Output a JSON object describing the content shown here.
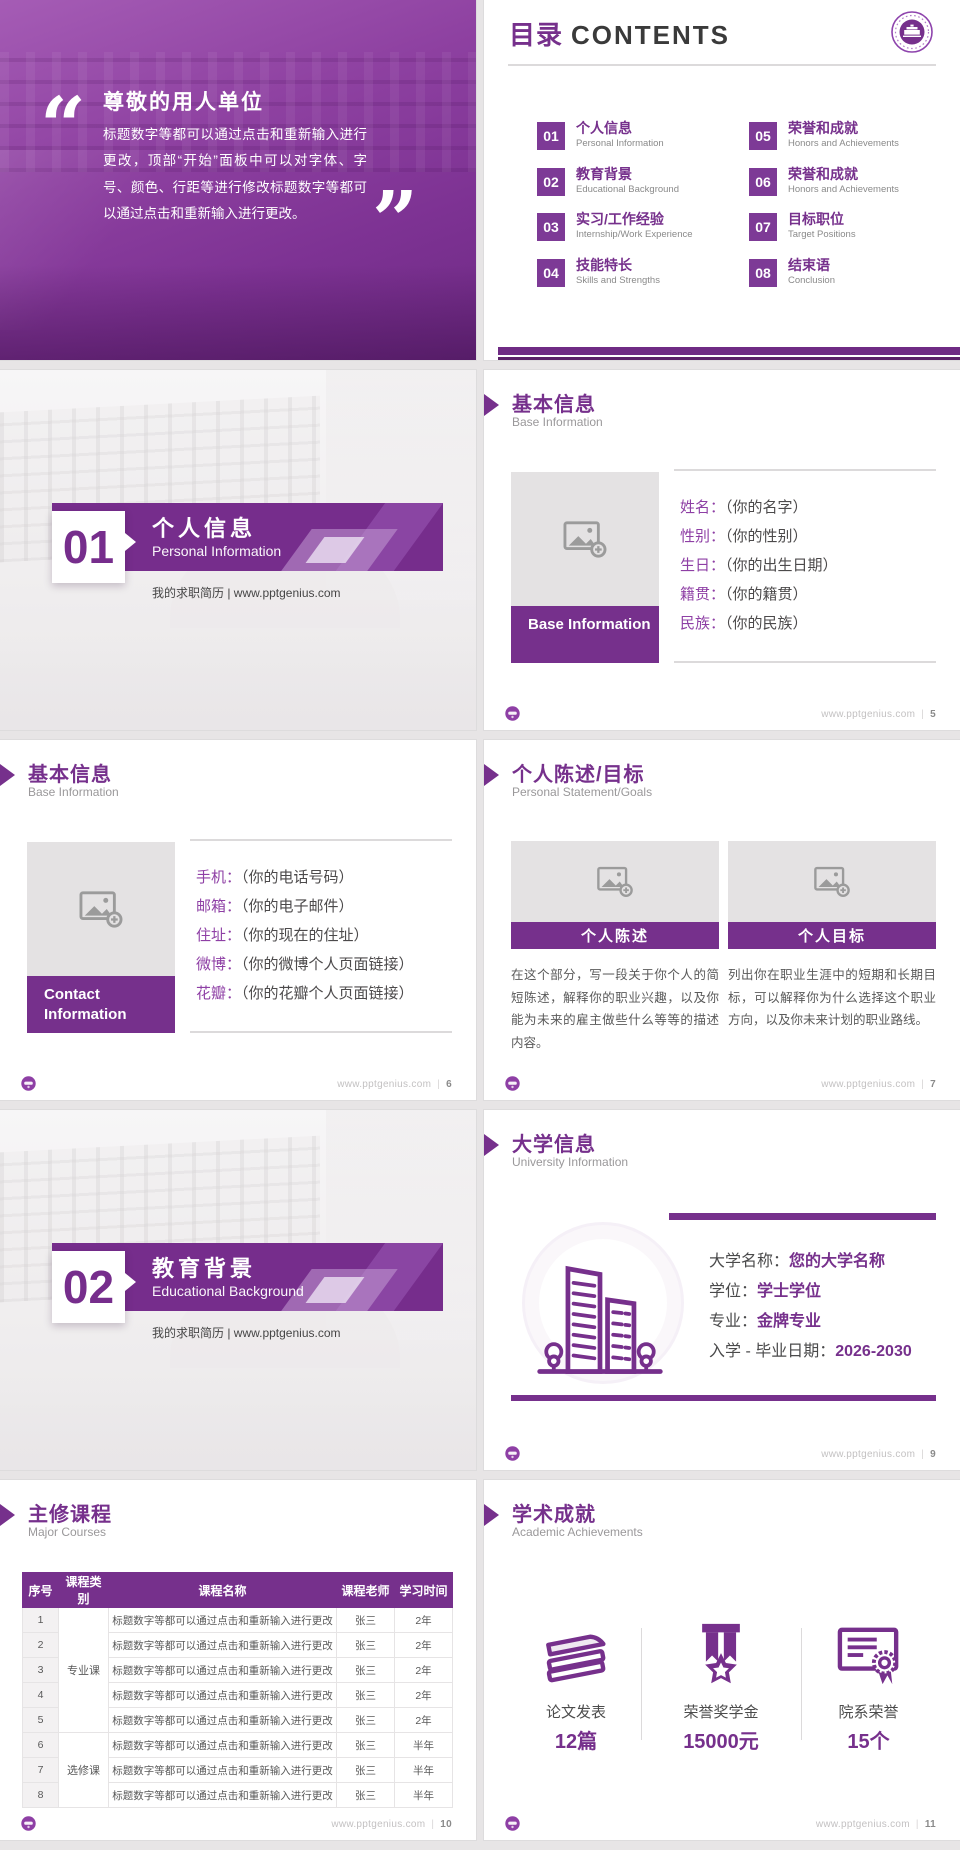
{
  "colors": {
    "accent": "#76308C",
    "accent_badge": "#7D3A96",
    "accent_deep": "#5B2169",
    "banner_bar": "#6F2B84",
    "field_label": "#8E3FA5",
    "text_dark": "#3A3A3A",
    "text_body": "#595959",
    "text_muted": "#9A989A",
    "footer_text": "#C3C1C2",
    "placeholder_bg": "#E4E2E3"
  },
  "footer_site": "www.pptgenius.com",
  "footer_sep": "|",
  "cover": {
    "open_quote": "“",
    "close_quote": "”",
    "title": "尊敬的用人单位",
    "body": "标题数字等都可以通过点击和重新输入进行更改，顶部“开始”面板中可以对字体、字号、颜色、行距等进行修改标题数字等都可以通过点击和重新输入进行更改。"
  },
  "contents": {
    "title_zh": "目录",
    "title_en": "CONTENTS",
    "items": [
      {
        "num": "01",
        "zh": "个人信息",
        "en": "Personal Information"
      },
      {
        "num": "02",
        "zh": "教育背景",
        "en": "Educational Background"
      },
      {
        "num": "03",
        "zh": "实习/工作经验",
        "en": "Internship/Work Experience"
      },
      {
        "num": "04",
        "zh": "技能特长",
        "en": "Skills and Strengths"
      },
      {
        "num": "05",
        "zh": "荣誉和成就",
        "en": "Honors and Achievements"
      },
      {
        "num": "06",
        "zh": "荣誉和成就",
        "en": "Honors and Achievements"
      },
      {
        "num": "07",
        "zh": "目标职位",
        "en": "Target Positions"
      },
      {
        "num": "08",
        "zh": "结束语",
        "en": "Conclusion"
      }
    ]
  },
  "section1": {
    "num": "01",
    "zh": "个人信息",
    "en": "Personal Information",
    "tagline": "我的求职简历 | www.pptgenius.com"
  },
  "section2": {
    "num": "02",
    "zh": "教育背景",
    "en": "Educational Background",
    "tagline": "我的求职简历 | www.pptgenius.com"
  },
  "base_info": {
    "zh": "基本信息",
    "en": "Base Information",
    "label": "Base Information",
    "fields": [
      {
        "k": "姓名：",
        "v": "（你的名字）"
      },
      {
        "k": "性别：",
        "v": "（你的性别）"
      },
      {
        "k": "生日：",
        "v": "（你的出生日期）"
      },
      {
        "k": "籍贯：",
        "v": "（你的籍贯）"
      },
      {
        "k": "民族：",
        "v": "（你的民族）"
      }
    ],
    "page": "5"
  },
  "contact": {
    "zh": "基本信息",
    "en": "Base Information",
    "label": "Contact Information",
    "fields": [
      {
        "k": "手机：",
        "v": "（你的电话号码）"
      },
      {
        "k": "邮箱：",
        "v": "（你的电子邮件）"
      },
      {
        "k": "住址：",
        "v": "（你的现在的住址）"
      },
      {
        "k": "微博：",
        "v": "（你的微博个人页面链接）"
      },
      {
        "k": "花瓣：",
        "v": "（你的花瓣个人页面链接）"
      }
    ],
    "page": "6"
  },
  "statement": {
    "zh": "个人陈述/目标",
    "en": "Personal Statement/Goals",
    "cards": [
      {
        "title": "个人陈述",
        "body": "在这个部分，写一段关于你个人的简短陈述，解释你的职业兴趣，以及你能为未来的雇主做些什么等等的描述内容。"
      },
      {
        "title": "个人目标",
        "body": "列出你在职业生涯中的短期和长期目标，可以解释你为什么选择这个职业方向，以及你未来计划的职业路线。"
      }
    ],
    "page": "7"
  },
  "university": {
    "zh": "大学信息",
    "en": "University Information",
    "fields": [
      {
        "k": "大学名称：",
        "v": "您的大学名称"
      },
      {
        "k": "学位：",
        "v": "学士学位"
      },
      {
        "k": "专业：",
        "v": "金牌专业"
      },
      {
        "k": "入学 - 毕业日期：",
        "v": "2026-2030"
      }
    ],
    "page": "9"
  },
  "courses": {
    "zh": "主修课程",
    "en": "Major Courses",
    "headers": [
      "序号",
      "课程类别",
      "课程名称",
      "课程老师",
      "学习时间"
    ],
    "cat1": "专业课",
    "cat2": "选修课",
    "rows": [
      {
        "no": "1",
        "name": "标题数字等都可以通过点击和重新输入进行更改",
        "t": "张三",
        "d": "2年"
      },
      {
        "no": "2",
        "name": "标题数字等都可以通过点击和重新输入进行更改",
        "t": "张三",
        "d": "2年"
      },
      {
        "no": "3",
        "name": "标题数字等都可以通过点击和重新输入进行更改",
        "t": "张三",
        "d": "2年"
      },
      {
        "no": "4",
        "name": "标题数字等都可以通过点击和重新输入进行更改",
        "t": "张三",
        "d": "2年"
      },
      {
        "no": "5",
        "name": "标题数字等都可以通过点击和重新输入进行更改",
        "t": "张三",
        "d": "2年"
      },
      {
        "no": "6",
        "name": "标题数字等都可以通过点击和重新输入进行更改",
        "t": "张三",
        "d": "半年"
      },
      {
        "no": "7",
        "name": "标题数字等都可以通过点击和重新输入进行更改",
        "t": "张三",
        "d": "半年"
      },
      {
        "no": "8",
        "name": "标题数字等都可以通过点击和重新输入进行更改",
        "t": "张三",
        "d": "半年"
      }
    ],
    "page": "10"
  },
  "achievements": {
    "zh": "学术成就",
    "en": "Academic Achievements",
    "stats": [
      {
        "label": "论文发表",
        "value": "12篇",
        "icon": "papers-icon"
      },
      {
        "label": "荣誉奖学金",
        "value": "15000元",
        "icon": "medal-icon"
      },
      {
        "label": "院系荣誉",
        "value": "15个",
        "icon": "certificate-icon"
      }
    ],
    "page": "11"
  }
}
